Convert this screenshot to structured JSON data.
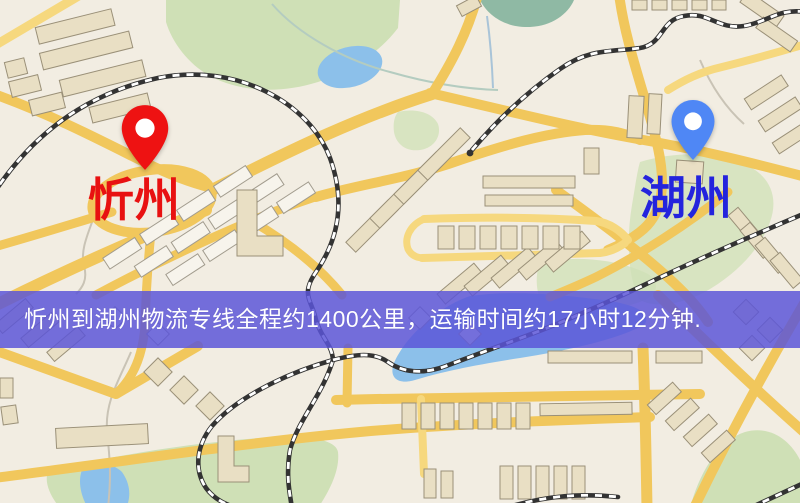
{
  "banner": {
    "text": "忻州到湖州物流专线全程约1400公里，运输时间约17小时12分钟.",
    "background_color": "#5a55d8",
    "text_color": "#ffffff"
  },
  "markers": {
    "origin": {
      "name": "忻州",
      "pin_color": "#ee1212",
      "label_color": "#e81111"
    },
    "destination": {
      "name": "湖州",
      "pin_color": "#4f87f5",
      "label_color": "#2424dd"
    }
  },
  "map_colors": {
    "background": "#f2ede2",
    "road": "#f1c75c",
    "road_light": "#f6d87e",
    "park": "#cfe0b6",
    "water": "#8cc0ea",
    "building": "#e9dfc4",
    "building_white": "#f7f4ec",
    "railway": "#333333"
  }
}
